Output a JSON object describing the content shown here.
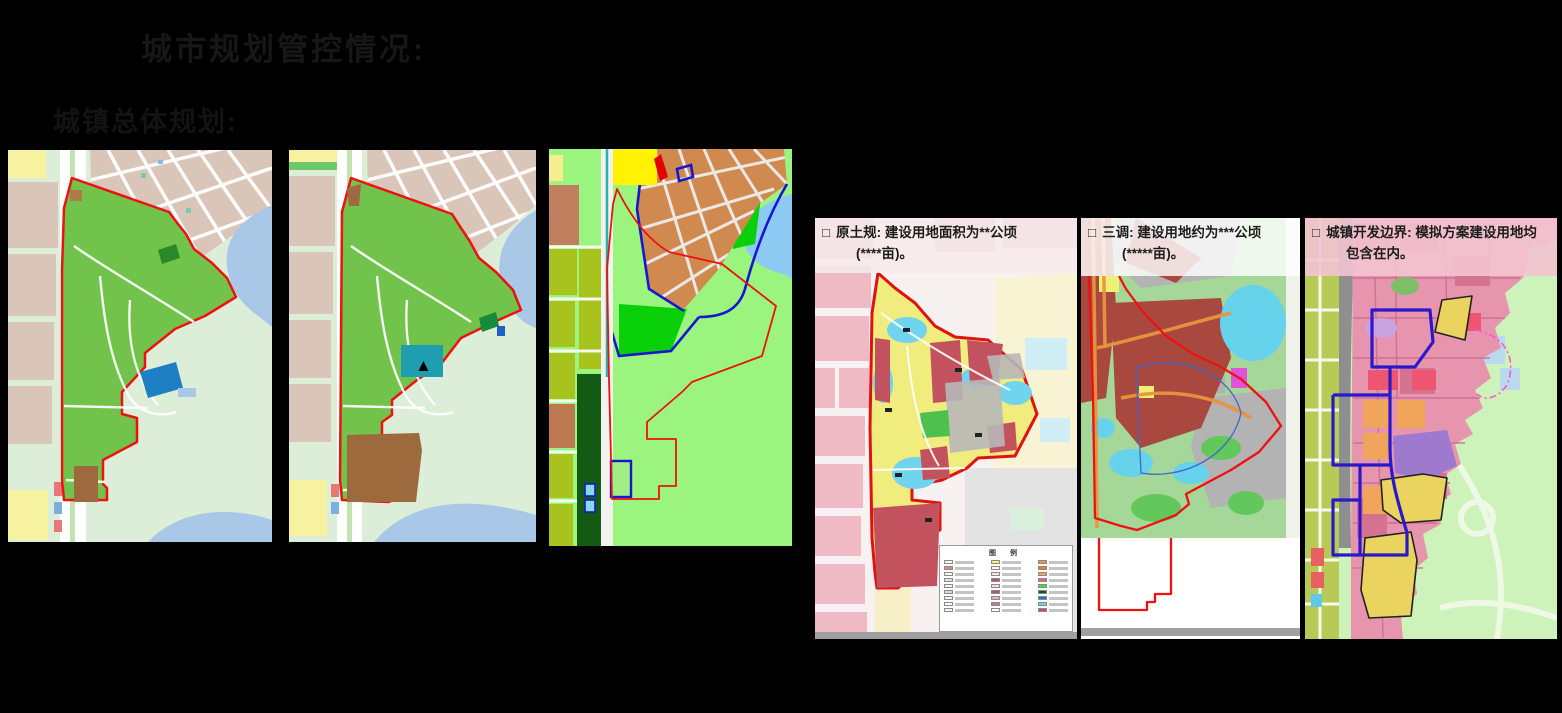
{
  "slide": {
    "title": "城市规划管控情况:",
    "subtitle": "城镇总体规划:"
  },
  "annotations": {
    "yuantugui": {
      "bullet": "□",
      "label": "原土规:",
      "line1": "建设用地面积为**公顷",
      "line2": "(****亩)。"
    },
    "sandiao": {
      "bullet": "□",
      "label": "三调:",
      "line1": "建设用地约为***公顷",
      "line2": "(*****亩)。"
    },
    "kaifa": {
      "bullet": "□",
      "label": "城镇开发边界:",
      "line1": "模拟方案建设用地均",
      "line2": "包含在内。"
    }
  },
  "legend": {
    "title": "图 例",
    "columns": [
      [
        "#f5f5f5",
        "#f08080",
        "#f5f5f5",
        "#e2e2e2",
        "#f5f5f5",
        "#f5c8c8",
        "#f5f5f5",
        "#ffffff",
        "#f5f5f5"
      ],
      [
        "#f7f37a",
        "#ffffff",
        "#f6e3e6",
        "#c25060",
        "#f2dede",
        "#c25060",
        "#e8b0bc",
        "#c87888",
        "#ffffff"
      ],
      [
        "#f0913e",
        "#ed7d1f",
        "#f2a45c",
        "#e8627a",
        "#42e03c",
        "#0c5c0c",
        "#2b6fe8",
        "#5cd8f2",
        "#d84860"
      ]
    ]
  },
  "icons": {
    "tower_marker": "▲"
  },
  "colors": {
    "slide_background": "#000000",
    "title_text": "#171717",
    "annotation_text": "#1c1c1c",
    "site_boundary_red": "#ee1111",
    "master_plan_green": "#72c34c",
    "master_plan_tan": "#d9c6b8",
    "master_plan_lake": "#a9c7e6",
    "master_plan_bg": "#dceed8",
    "blue_parcel": "#1e7fc4",
    "teal_parcel": "#1e9eae",
    "brown_parcel": "#9c6a3c",
    "zoning_orange": "#d08a50",
    "zoning_bright_green": "#0ad00a",
    "zoning_light_green": "#9af47e",
    "zoning_blue_line": "#1717d2",
    "zoning_dark_green": "#135a13",
    "zoning_olive": "#a8c21e",
    "tugui_rose": "#c2525e",
    "tugui_yellow": "#f1ec7e",
    "tugui_cyan": "#70d4ee",
    "tugui_pink_blocks": "#efbac4",
    "sandiao_dark_red": "#a8483e",
    "sandiao_cyan": "#66d2ec",
    "sandiao_orange_road": "#e8953c",
    "kaifa_pink": "#e795ae",
    "kaifa_blue_boundary": "#2a18cc",
    "kaifa_yellow": "#ead35e",
    "kaifa_purple": "#9d7ace",
    "kaifa_magenta_dash": "#ff55d5"
  }
}
